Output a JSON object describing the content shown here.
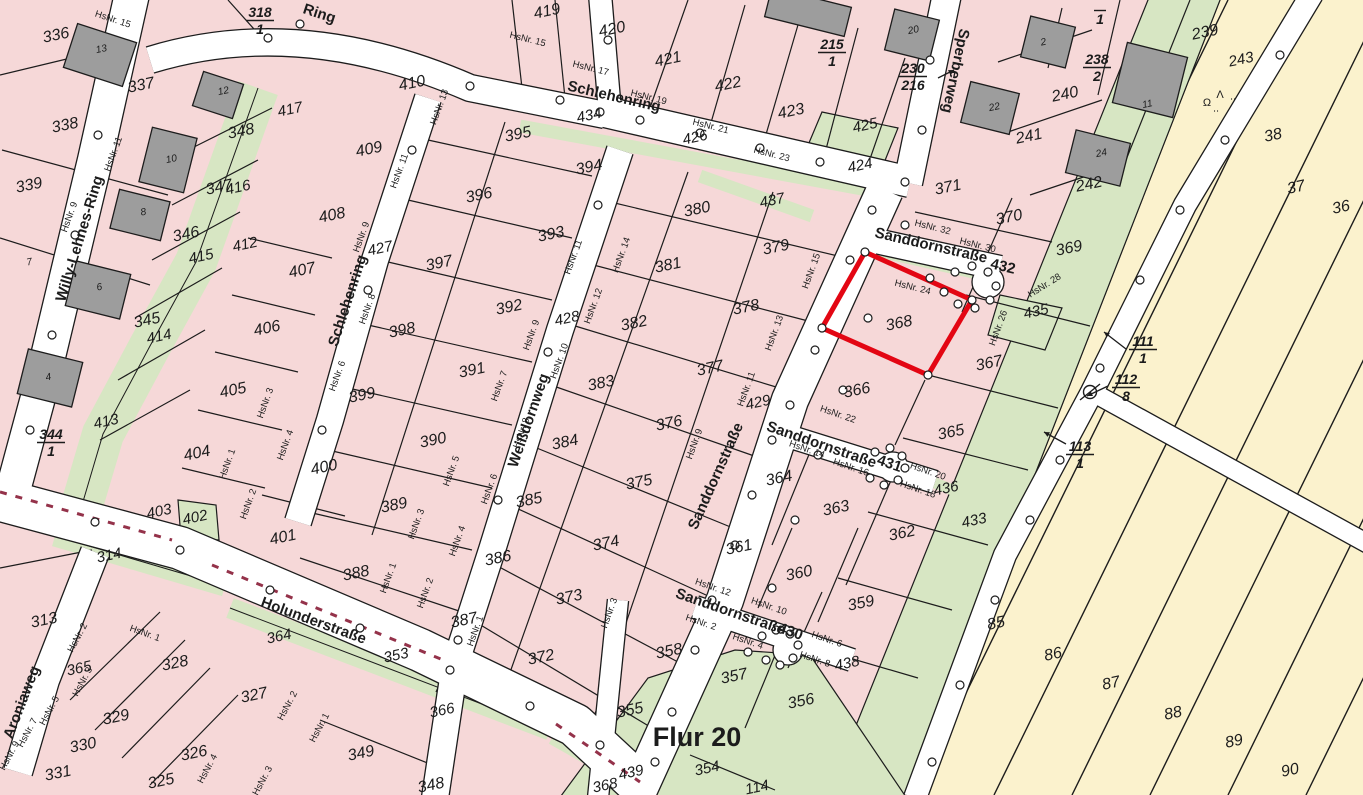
{
  "map": {
    "flur_label": "Flur 20",
    "highlight": {
      "parcel": "368",
      "color": "#e30613"
    },
    "colors": {
      "parcel_pink": "#f6d8d8",
      "green_area": "#d7e6c3",
      "field_yellow": "#fbf2cd",
      "street_white": "#ffffff",
      "building_gray": "#9d9d9d",
      "highlight_red": "#e30613",
      "line_black": "#1c1c1c",
      "boundary_hatch_red": "#94324a",
      "vegetation_green": "#2e8b2e"
    },
    "streets": [
      {
        "name": "Willy-Lehnes-Ring",
        "x": 84,
        "y": 240,
        "rot": -73,
        "size": 15
      },
      {
        "name": "Ring",
        "x": 318,
        "y": 18,
        "rot": 18,
        "size": 15
      },
      {
        "name": "Schlehenring",
        "x": 613,
        "y": 101,
        "rot": 13,
        "size": 16
      },
      {
        "name": "Schlehenring",
        "x": 352,
        "y": 302,
        "rot": -72,
        "size": 16
      },
      {
        "name": "Sperberweg",
        "x": 951,
        "y": 70,
        "rot": 102,
        "size": 15
      },
      {
        "name": "Sanddornstraße",
        "x": 720,
        "y": 478,
        "rot": -66,
        "size": 16
      },
      {
        "name": "Weißdornweg",
        "x": 533,
        "y": 422,
        "rot": -71,
        "size": 15
      },
      {
        "name": "Holunderstraße",
        "x": 312,
        "y": 625,
        "rot": 20,
        "size": 16
      },
      {
        "name": "Aroniaweg",
        "x": 26,
        "y": 704,
        "rot": -69,
        "size": 15
      },
      {
        "name": "Sanddornstraße",
        "x": 930,
        "y": 250,
        "rot": 13,
        "size": 14
      },
      {
        "name": "432",
        "x": 1002,
        "y": 271,
        "rot": 13,
        "size": 14
      },
      {
        "name": "Sanddornstraße",
        "x": 820,
        "y": 449,
        "rot": 19,
        "size": 14
      },
      {
        "name": "431",
        "x": 888,
        "y": 468,
        "rot": 19,
        "size": 14
      },
      {
        "name": "Sanddornstraße",
        "x": 729,
        "y": 616,
        "rot": 19,
        "size": 14
      },
      {
        "name": "430",
        "x": 789,
        "y": 636,
        "rot": 19,
        "size": 14
      }
    ],
    "parcel_numbers": [
      {
        "label": "336",
        "x": 57,
        "y": 40
      },
      {
        "label": "337",
        "x": 142,
        "y": 90
      },
      {
        "label": "338",
        "x": 66,
        "y": 130
      },
      {
        "label": "339",
        "x": 30,
        "y": 190
      },
      {
        "label": "348",
        "x": 242,
        "y": 136
      },
      {
        "label": "347",
        "x": 220,
        "y": 192
      },
      {
        "label": "346",
        "x": 187,
        "y": 239
      },
      {
        "label": "345",
        "x": 148,
        "y": 325
      },
      {
        "label": "313",
        "x": 45,
        "y": 625
      },
      {
        "label": "328",
        "x": 176,
        "y": 668
      },
      {
        "label": "329",
        "x": 117,
        "y": 722
      },
      {
        "label": "330",
        "x": 84,
        "y": 750
      },
      {
        "label": "331",
        "x": 59,
        "y": 778
      },
      {
        "label": "327",
        "x": 255,
        "y": 700
      },
      {
        "label": "326",
        "x": 195,
        "y": 758
      },
      {
        "label": "325",
        "x": 162,
        "y": 786
      },
      {
        "label": "408",
        "x": 333,
        "y": 220
      },
      {
        "label": "407",
        "x": 303,
        "y": 275
      },
      {
        "label": "406",
        "x": 268,
        "y": 333
      },
      {
        "label": "405",
        "x": 234,
        "y": 395
      },
      {
        "label": "404",
        "x": 198,
        "y": 458
      },
      {
        "label": "400",
        "x": 325,
        "y": 472
      },
      {
        "label": "401",
        "x": 284,
        "y": 542
      },
      {
        "label": "419",
        "x": 548,
        "y": 16
      },
      {
        "label": "420",
        "x": 613,
        "y": 34
      },
      {
        "label": "421",
        "x": 669,
        "y": 64
      },
      {
        "label": "422",
        "x": 729,
        "y": 89
      },
      {
        "label": "423",
        "x": 792,
        "y": 116
      },
      {
        "label": "410",
        "x": 413,
        "y": 88
      },
      {
        "label": "409",
        "x": 370,
        "y": 154
      },
      {
        "label": "395",
        "x": 519,
        "y": 139
      },
      {
        "label": "394",
        "x": 590,
        "y": 172
      },
      {
        "label": "396",
        "x": 480,
        "y": 200
      },
      {
        "label": "393",
        "x": 552,
        "y": 239
      },
      {
        "label": "397",
        "x": 440,
        "y": 268
      },
      {
        "label": "392",
        "x": 510,
        "y": 312
      },
      {
        "label": "398",
        "x": 403,
        "y": 335
      },
      {
        "label": "391",
        "x": 473,
        "y": 375
      },
      {
        "label": "399",
        "x": 363,
        "y": 400
      },
      {
        "label": "390",
        "x": 434,
        "y": 445
      },
      {
        "label": "389",
        "x": 395,
        "y": 510
      },
      {
        "label": "388",
        "x": 357,
        "y": 578
      },
      {
        "label": "384",
        "x": 566,
        "y": 447
      },
      {
        "label": "385",
        "x": 530,
        "y": 505
      },
      {
        "label": "386",
        "x": 499,
        "y": 563
      },
      {
        "label": "387",
        "x": 465,
        "y": 625
      },
      {
        "label": "372",
        "x": 542,
        "y": 662
      },
      {
        "label": "373",
        "x": 570,
        "y": 602
      },
      {
        "label": "374",
        "x": 607,
        "y": 548
      },
      {
        "label": "375",
        "x": 640,
        "y": 487
      },
      {
        "label": "376",
        "x": 670,
        "y": 428
      },
      {
        "label": "377",
        "x": 711,
        "y": 373
      },
      {
        "label": "378",
        "x": 747,
        "y": 312
      },
      {
        "label": "379",
        "x": 777,
        "y": 252
      },
      {
        "label": "380",
        "x": 698,
        "y": 214
      },
      {
        "label": "381",
        "x": 669,
        "y": 270
      },
      {
        "label": "382",
        "x": 635,
        "y": 328
      },
      {
        "label": "383",
        "x": 602,
        "y": 388
      },
      {
        "label": "366",
        "x": 858,
        "y": 395
      },
      {
        "label": "367",
        "x": 990,
        "y": 368
      },
      {
        "label": "368",
        "x": 900,
        "y": 328
      },
      {
        "label": "369",
        "x": 1070,
        "y": 253
      },
      {
        "label": "370",
        "x": 1010,
        "y": 222
      },
      {
        "label": "371",
        "x": 949,
        "y": 192
      },
      {
        "label": "364",
        "x": 780,
        "y": 483
      },
      {
        "label": "365",
        "x": 952,
        "y": 437
      },
      {
        "label": "363",
        "x": 837,
        "y": 513
      },
      {
        "label": "362",
        "x": 903,
        "y": 538
      },
      {
        "label": "361",
        "x": 740,
        "y": 552
      },
      {
        "label": "360",
        "x": 800,
        "y": 578
      },
      {
        "label": "359",
        "x": 862,
        "y": 608
      },
      {
        "label": "358",
        "x": 670,
        "y": 656
      },
      {
        "label": "357",
        "x": 735,
        "y": 681
      },
      {
        "label": "356",
        "x": 802,
        "y": 706
      },
      {
        "label": "355",
        "x": 631,
        "y": 715
      },
      {
        "label": "349",
        "x": 362,
        "y": 758
      },
      {
        "label": "348",
        "x": 432,
        "y": 790
      },
      {
        "label": "239",
        "x": 1206,
        "y": 37
      },
      {
        "label": "240",
        "x": 1066,
        "y": 99
      },
      {
        "label": "241",
        "x": 1030,
        "y": 141
      },
      {
        "label": "242",
        "x": 1090,
        "y": 189
      },
      {
        "label": "85",
        "x": 997,
        "y": 628
      },
      {
        "label": "86",
        "x": 1054,
        "y": 659
      },
      {
        "label": "87",
        "x": 1112,
        "y": 688
      },
      {
        "label": "88",
        "x": 1174,
        "y": 718
      },
      {
        "label": "89",
        "x": 1235,
        "y": 746
      },
      {
        "label": "90",
        "x": 1291,
        "y": 775
      },
      {
        "label": "38",
        "x": 1274,
        "y": 140
      },
      {
        "label": "37",
        "x": 1297,
        "y": 192
      },
      {
        "label": "36",
        "x": 1342,
        "y": 212
      }
    ],
    "street_parcel_numbers": [
      {
        "label": "417",
        "x": 291,
        "y": 114
      },
      {
        "label": "416",
        "x": 239,
        "y": 192
      },
      {
        "label": "415",
        "x": 202,
        "y": 261
      },
      {
        "label": "414",
        "x": 160,
        "y": 341
      },
      {
        "label": "413",
        "x": 107,
        "y": 426
      },
      {
        "label": "412",
        "x": 246,
        "y": 249
      },
      {
        "label": "402",
        "x": 196,
        "y": 522
      },
      {
        "label": "403",
        "x": 160,
        "y": 516
      },
      {
        "label": "426",
        "x": 696,
        "y": 142
      },
      {
        "label": "424",
        "x": 861,
        "y": 170
      },
      {
        "label": "425",
        "x": 866,
        "y": 130
      },
      {
        "label": "437",
        "x": 773,
        "y": 205
      },
      {
        "label": "427",
        "x": 381,
        "y": 253
      },
      {
        "label": "428",
        "x": 568,
        "y": 323
      },
      {
        "label": "429",
        "x": 759,
        "y": 407
      },
      {
        "label": "434",
        "x": 590,
        "y": 120
      },
      {
        "label": "433",
        "x": 975,
        "y": 525
      },
      {
        "label": "435",
        "x": 1037,
        "y": 316
      },
      {
        "label": "436",
        "x": 947,
        "y": 493
      },
      {
        "label": "438",
        "x": 848,
        "y": 668
      },
      {
        "label": "439",
        "x": 632,
        "y": 777
      },
      {
        "label": "353",
        "x": 397,
        "y": 660
      },
      {
        "label": "365",
        "x": 80,
        "y": 673
      },
      {
        "label": "314",
        "x": 110,
        "y": 560
      },
      {
        "label": "364",
        "x": 280,
        "y": 641
      },
      {
        "label": "366",
        "x": 443,
        "y": 715
      },
      {
        "label": "368",
        "x": 606,
        "y": 790
      },
      {
        "label": "243",
        "x": 1242,
        "y": 64
      },
      {
        "label": "354",
        "x": 708,
        "y": 773
      },
      {
        "label": "114",
        "x": 758,
        "y": 792
      }
    ],
    "fractions": [
      {
        "num": "318",
        "den": "1",
        "x": 260,
        "y": 6
      },
      {
        "num": "344",
        "den": "1",
        "x": 51,
        "y": 428
      },
      {
        "num": "215",
        "den": "1",
        "x": 832,
        "y": 38
      },
      {
        "num": "238",
        "den": "2",
        "x": 1097,
        "y": 53
      },
      {
        "num": "",
        "den": "1",
        "x": 1100,
        "y": -4
      },
      {
        "num": "230",
        "den": "216",
        "x": 913,
        "y": 62,
        "arrow": [
          938,
          78,
          954,
          70
        ]
      },
      {
        "num": "111",
        "den": "1",
        "x": 1143,
        "y": 335,
        "arrow": [
          1126,
          349,
          1104,
          332
        ]
      },
      {
        "num": "112",
        "den": "8",
        "x": 1126,
        "y": 373,
        "arrow": [
          1108,
          386,
          1087,
          396
        ]
      },
      {
        "num": "113",
        "den": "1",
        "x": 1080,
        "y": 440,
        "arrow": [
          1066,
          444,
          1044,
          432
        ]
      }
    ],
    "house_numbers": [
      {
        "label": "HsNr. 15",
        "x": 112,
        "y": 22,
        "rot": 18
      },
      {
        "label": "HsNr. 11",
        "x": 116,
        "y": 155,
        "rot": -70
      },
      {
        "label": "HsNr. 9",
        "x": 72,
        "y": 218,
        "rot": -70
      },
      {
        "label": "HsNr. 15",
        "x": 527,
        "y": 42,
        "rot": 14
      },
      {
        "label": "HsNr. 17",
        "x": 590,
        "y": 71,
        "rot": 14
      },
      {
        "label": "HsNr. 19",
        "x": 648,
        "y": 100,
        "rot": 14
      },
      {
        "label": "HsNr. 21",
        "x": 710,
        "y": 129,
        "rot": 14
      },
      {
        "label": "HsNr. 23",
        "x": 771,
        "y": 157,
        "rot": 14
      },
      {
        "label": "HsNr. 13",
        "x": 442,
        "y": 108,
        "rot": -70
      },
      {
        "label": "HsNr. 11",
        "x": 402,
        "y": 172,
        "rot": -70
      },
      {
        "label": "HsNr. 9",
        "x": 364,
        "y": 238,
        "rot": -70
      },
      {
        "label": "HsNr. 8",
        "x": 370,
        "y": 310,
        "rot": -70
      },
      {
        "label": "HsNr. 6",
        "x": 340,
        "y": 377,
        "rot": -70
      },
      {
        "label": "HsNr. 3",
        "x": 268,
        "y": 404,
        "rot": -70
      },
      {
        "label": "HsNr. 1",
        "x": 230,
        "y": 465,
        "rot": -70
      },
      {
        "label": "HsNr. 4",
        "x": 288,
        "y": 446,
        "rot": -70
      },
      {
        "label": "HsNr. 2",
        "x": 251,
        "y": 505,
        "rot": -70
      },
      {
        "label": "HsNr. 14",
        "x": 624,
        "y": 256,
        "rot": -70
      },
      {
        "label": "HsNr. 11",
        "x": 576,
        "y": 258,
        "rot": -70
      },
      {
        "label": "HsNr. 12",
        "x": 596,
        "y": 307,
        "rot": -70
      },
      {
        "label": "HsNr. 9",
        "x": 534,
        "y": 336,
        "rot": -70
      },
      {
        "label": "HsNr. 10",
        "x": 562,
        "y": 362,
        "rot": -70
      },
      {
        "label": "HsNr. 7",
        "x": 502,
        "y": 387,
        "rot": -70
      },
      {
        "label": "HsNr. 8",
        "x": 524,
        "y": 434,
        "rot": -70
      },
      {
        "label": "HsNr. 5",
        "x": 454,
        "y": 472,
        "rot": -70
      },
      {
        "label": "HsNr. 6",
        "x": 492,
        "y": 490,
        "rot": -70
      },
      {
        "label": "HsNr. 3",
        "x": 419,
        "y": 525,
        "rot": -70
      },
      {
        "label": "HsNr. 4",
        "x": 460,
        "y": 542,
        "rot": -70
      },
      {
        "label": "HsNr. 1",
        "x": 391,
        "y": 579,
        "rot": -70
      },
      {
        "label": "HsNr. 2",
        "x": 428,
        "y": 594,
        "rot": -70
      },
      {
        "label": "HsNr. 15",
        "x": 814,
        "y": 272,
        "rot": -70
      },
      {
        "label": "HsNr. 13",
        "x": 777,
        "y": 334,
        "rot": -70
      },
      {
        "label": "HsNr. 11",
        "x": 749,
        "y": 390,
        "rot": -70
      },
      {
        "label": "HsNr. 9",
        "x": 697,
        "y": 445,
        "rot": -70
      },
      {
        "label": "HsNr. 24",
        "x": 912,
        "y": 290,
        "rot": 14
      },
      {
        "label": "HsNr. 26",
        "x": 1001,
        "y": 329,
        "rot": -70
      },
      {
        "label": "HsNr. 28",
        "x": 1046,
        "y": 288,
        "rot": -32
      },
      {
        "label": "HsNr. 32",
        "x": 932,
        "y": 230,
        "rot": 14
      },
      {
        "label": "HsNr. 30",
        "x": 977,
        "y": 248,
        "rot": 14
      },
      {
        "label": "HsNr. 22",
        "x": 837,
        "y": 417,
        "rot": 19
      },
      {
        "label": "HsNr. 14",
        "x": 806,
        "y": 452,
        "rot": 19
      },
      {
        "label": "HsNr. 16",
        "x": 850,
        "y": 470,
        "rot": 19
      },
      {
        "label": "HsNr. 20",
        "x": 927,
        "y": 474,
        "rot": 19
      },
      {
        "label": "HsNr. 18",
        "x": 917,
        "y": 492,
        "rot": 19
      },
      {
        "label": "HsNr. 12",
        "x": 712,
        "y": 590,
        "rot": 19
      },
      {
        "label": "HsNr. 10",
        "x": 768,
        "y": 609,
        "rot": 19
      },
      {
        "label": "HsNr. 2",
        "x": 700,
        "y": 625,
        "rot": 19
      },
      {
        "label": "HsNr. 4",
        "x": 747,
        "y": 644,
        "rot": 19
      },
      {
        "label": "HsNr. 6",
        "x": 826,
        "y": 642,
        "rot": 19
      },
      {
        "label": "HsNr. 8",
        "x": 814,
        "y": 662,
        "rot": 19
      },
      {
        "label": "HsNr. 2",
        "x": 80,
        "y": 639,
        "rot": -62
      },
      {
        "label": "HsNr. 1",
        "x": 144,
        "y": 636,
        "rot": 20
      },
      {
        "label": "HsNr. 3",
        "x": 85,
        "y": 683,
        "rot": -62
      },
      {
        "label": "HsNr. 5",
        "x": 52,
        "y": 712,
        "rot": -62
      },
      {
        "label": "HsNr. 7",
        "x": 30,
        "y": 734,
        "rot": -62
      },
      {
        "label": "HsNr. 9",
        "x": 12,
        "y": 757,
        "rot": -62
      },
      {
        "label": "HsNr. 2",
        "x": 290,
        "y": 707,
        "rot": -62
      },
      {
        "label": "HsNr. 1",
        "x": 322,
        "y": 729,
        "rot": -62
      },
      {
        "label": "HsNr. 4",
        "x": 210,
        "y": 770,
        "rot": -62
      },
      {
        "label": "HsNr. 3",
        "x": 265,
        "y": 782,
        "rot": -62
      },
      {
        "label": "HsNr. 1",
        "x": 478,
        "y": 632,
        "rot": -70
      },
      {
        "label": "HsNr. 3",
        "x": 612,
        "y": 614,
        "rot": -70
      }
    ],
    "building_numbers": [
      {
        "label": "13",
        "x": 102,
        "y": 52
      },
      {
        "label": "12",
        "x": 224,
        "y": 94
      },
      {
        "label": "10",
        "x": 172,
        "y": 162
      },
      {
        "label": "8",
        "x": 144,
        "y": 215
      },
      {
        "label": "6",
        "x": 100,
        "y": 290
      },
      {
        "label": "4",
        "x": 49,
        "y": 380
      },
      {
        "label": "7",
        "x": 30,
        "y": 265
      },
      {
        "label": "20",
        "x": 914,
        "y": 33
      },
      {
        "label": "22",
        "x": 995,
        "y": 110
      },
      {
        "label": "2",
        "x": 1044,
        "y": 45
      },
      {
        "label": "11",
        "x": 1148,
        "y": 107
      },
      {
        "label": "24",
        "x": 1102,
        "y": 156
      }
    ]
  }
}
